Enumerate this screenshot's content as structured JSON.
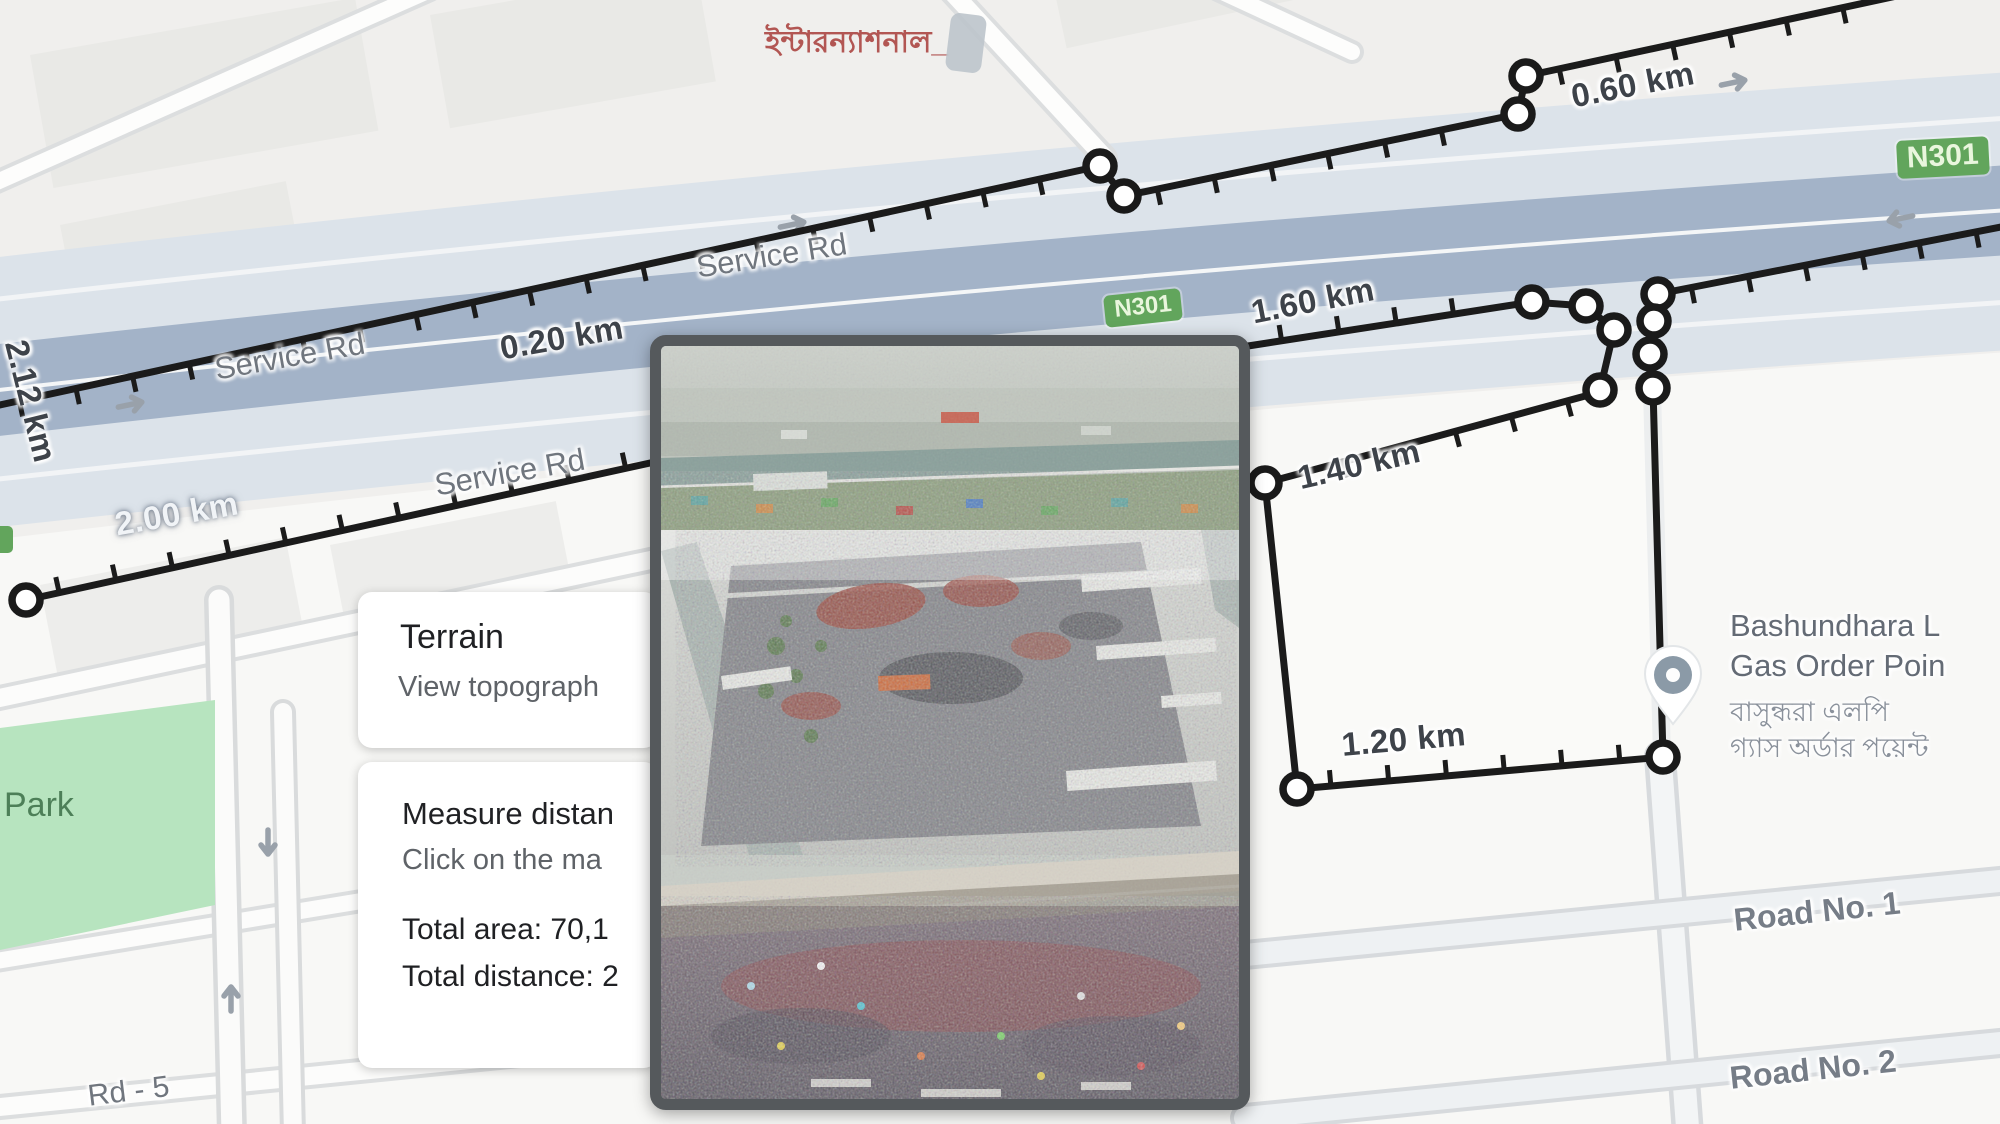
{
  "map": {
    "top_label_bn": "ইন্টারন্যাশনাল_",
    "street_labels": {
      "service_rd_a": "Service Rd",
      "service_rd_b": "Service Rd",
      "service_rd_c": "Service Rd",
      "park": "Park",
      "rd_5": "Rd - 5",
      "road_no_1": "Road No. 1",
      "road_no_2": "Road No. 2"
    },
    "route_badges": {
      "n301_center": "N301",
      "n301_right": "N301"
    },
    "measurement": {
      "d_0_20": "0.20 km",
      "d_0_60": "0.60 km",
      "d_1_20": "1.20 km",
      "d_1_40": "1.40 km",
      "d_1_60": "1.60 km",
      "d_2_00": "2.00 km",
      "d_2_12": "2.12 km"
    },
    "poi": {
      "name_line1": "Bashundhara L",
      "name_line2": "Gas Order Poin",
      "name_bn_line1": "বাসুন্ধরা এলপি",
      "name_bn_line2": "গ্যাস অর্ডার পয়েন্ট"
    }
  },
  "panels": {
    "terrain_card": {
      "title": "Terrain",
      "subtitle": "View topograph"
    },
    "measure_card": {
      "title": "Measure distan",
      "hint": "Click on the ma",
      "total_area": "Total area: 70,1",
      "total_distance": "Total distance: 2"
    }
  },
  "overlay_photo": {
    "alt": "Aerial crowd photos"
  },
  "colors": {
    "highway": "#a3b3c8",
    "corridor": "#dce3ea",
    "park_green": "#b7e4bf",
    "badge_green": "#62a55c",
    "measure_black": "#1b1b1b",
    "label_gray": "#70767e",
    "red_text": "#ad4a46"
  }
}
